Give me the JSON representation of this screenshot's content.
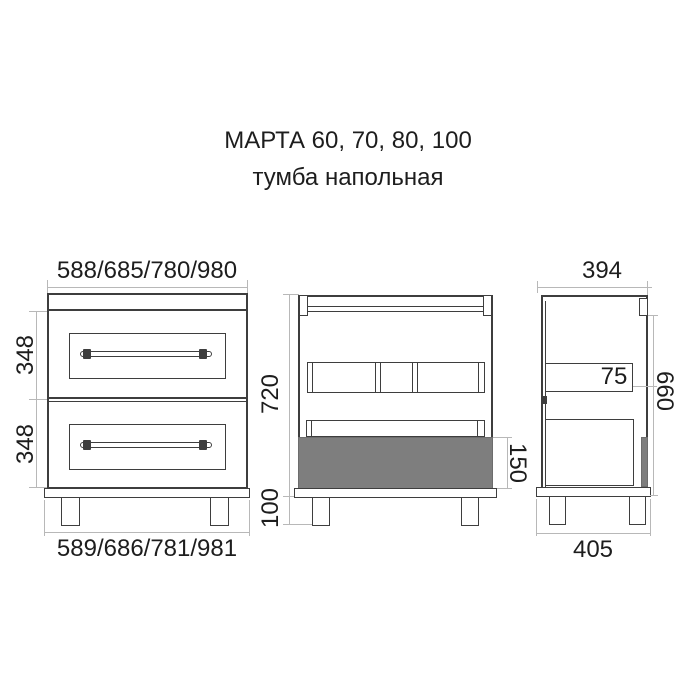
{
  "title": "МАРТА 60, 70, 80, 100",
  "subtitle": "тумба напольная",
  "views": {
    "front": {
      "label": "front view with drawers",
      "dim_width_top": "588/685/780/980",
      "dim_width_bottom": "589/686/781/981",
      "dim_drawer1_height": "348",
      "dim_drawer2_height": "348"
    },
    "carcass": {
      "label": "front view of carcass",
      "dim_body_height": "720",
      "dim_leg_height": "100",
      "dim_drawer_box_height": "150"
    },
    "side": {
      "label": "side view",
      "dim_depth_top": "394",
      "dim_depth_bottom": "405",
      "dim_mount_height": "660",
      "dim_rail_height": "75"
    }
  },
  "colors": {
    "outline": "#3e3e3e",
    "dimension_line": "#b8b8b8",
    "gray_fill": "#7e7e7e",
    "text": "#1d1d1d",
    "background": "#ffffff"
  }
}
